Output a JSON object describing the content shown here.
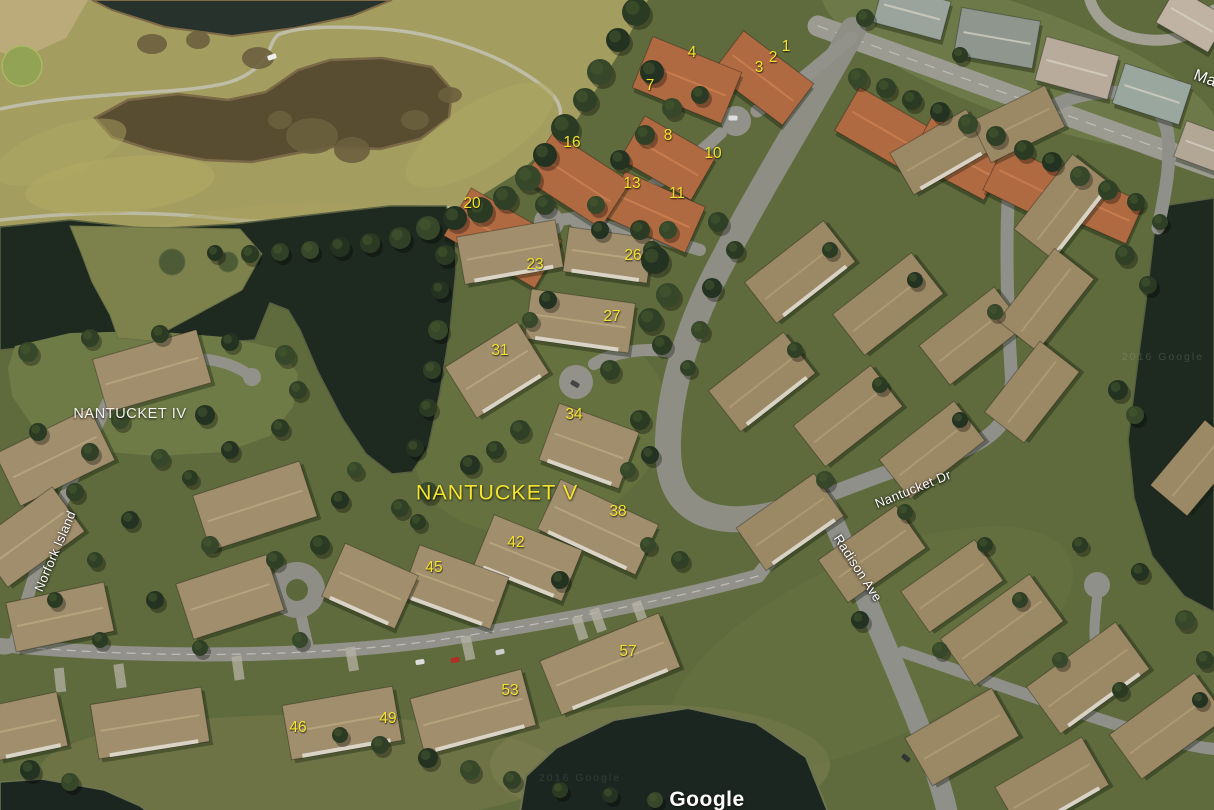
{
  "map": {
    "attribution": "Google",
    "area_labels": [
      {
        "text": "NANTUCKET IV",
        "x": 130,
        "y": 414,
        "rot": 0,
        "style": "area-white"
      },
      {
        "text": "NANTUCKET V",
        "x": 497,
        "y": 493,
        "rot": 0,
        "style": "area-yellow"
      }
    ],
    "street_labels": [
      {
        "text": "Norfork Island",
        "x": 55,
        "y": 551,
        "rot": -67,
        "edge": false
      },
      {
        "text": "Nantucket Dr",
        "x": 913,
        "y": 489,
        "rot": -22,
        "edge": false
      },
      {
        "text": "Radison Ave",
        "x": 858,
        "y": 568,
        "rot": 57,
        "edge": false
      },
      {
        "text": "Ma",
        "x": 1205,
        "y": 79,
        "rot": 20,
        "edge": true
      }
    ],
    "lot_numbers": [
      {
        "n": "1",
        "x": 786,
        "y": 47
      },
      {
        "n": "2",
        "x": 773,
        "y": 58
      },
      {
        "n": "3",
        "x": 759,
        "y": 68
      },
      {
        "n": "4",
        "x": 692,
        "y": 53
      },
      {
        "n": "7",
        "x": 650,
        "y": 86
      },
      {
        "n": "8",
        "x": 668,
        "y": 136
      },
      {
        "n": "10",
        "x": 713,
        "y": 154
      },
      {
        "n": "16",
        "x": 572,
        "y": 143
      },
      {
        "n": "13",
        "x": 632,
        "y": 184
      },
      {
        "n": "11",
        "x": 677,
        "y": 194
      },
      {
        "n": "20",
        "x": 472,
        "y": 204
      },
      {
        "n": "23",
        "x": 535,
        "y": 265
      },
      {
        "n": "26",
        "x": 633,
        "y": 256
      },
      {
        "n": "27",
        "x": 612,
        "y": 317
      },
      {
        "n": "31",
        "x": 500,
        "y": 351
      },
      {
        "n": "34",
        "x": 574,
        "y": 415
      },
      {
        "n": "38",
        "x": 618,
        "y": 512
      },
      {
        "n": "42",
        "x": 516,
        "y": 543
      },
      {
        "n": "45",
        "x": 434,
        "y": 568
      },
      {
        "n": "57",
        "x": 628,
        "y": 652
      },
      {
        "n": "53",
        "x": 510,
        "y": 691
      },
      {
        "n": "49",
        "x": 388,
        "y": 719
      },
      {
        "n": "46",
        "x": 298,
        "y": 728
      }
    ],
    "watermarks": [
      {
        "text": "2016 Google",
        "x": 1163,
        "y": 357,
        "opacity": 0.18
      },
      {
        "text": "2016 Google",
        "x": 580,
        "y": 778,
        "opacity": 0.12
      }
    ]
  }
}
